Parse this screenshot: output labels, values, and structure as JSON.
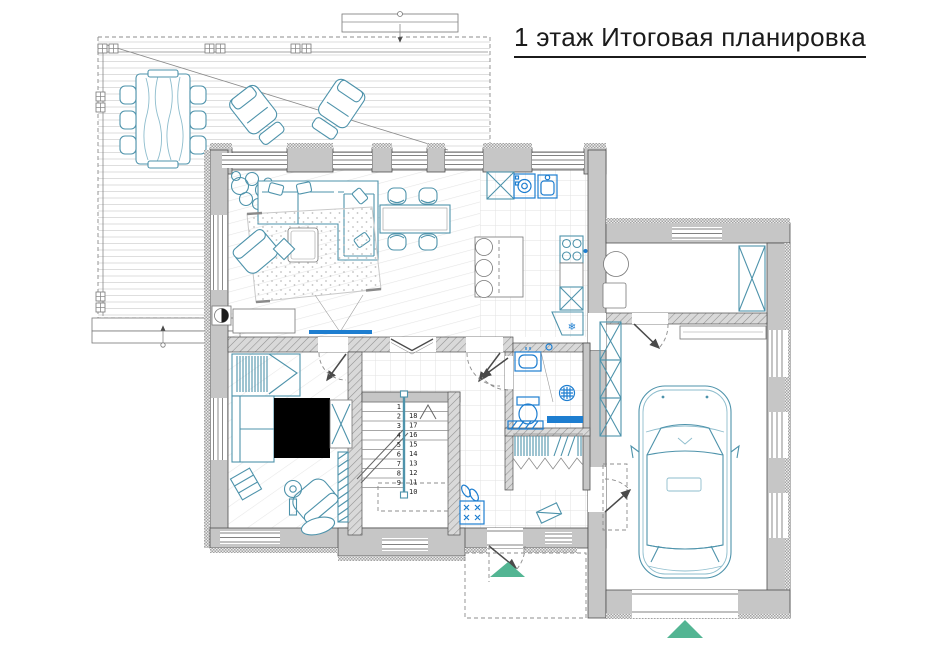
{
  "title": "1 этаж Итоговая планировка",
  "stairs": {
    "left_numbers": [
      "1",
      "2",
      "3",
      "4",
      "5",
      "6",
      "7",
      "8",
      "9"
    ],
    "right_numbers": [
      "18",
      "17",
      "16",
      "15",
      "14",
      "13",
      "12",
      "11",
      "10"
    ]
  },
  "icons": {
    "snowflake": "❄",
    "entrance_arrow": "▲",
    "stairs_up_arrow": "∧",
    "section_marker": "◐"
  },
  "palette": {
    "wall_gray": "#c6c6c6",
    "wall_stroke": "#4f4f4f",
    "furniture_teal": "#4e93ab",
    "fixture_blue": "#1e7ed0",
    "accent_green": "#53b593",
    "dash_gray": "#8c8c8c",
    "floor_line": "#e3e3e3"
  }
}
